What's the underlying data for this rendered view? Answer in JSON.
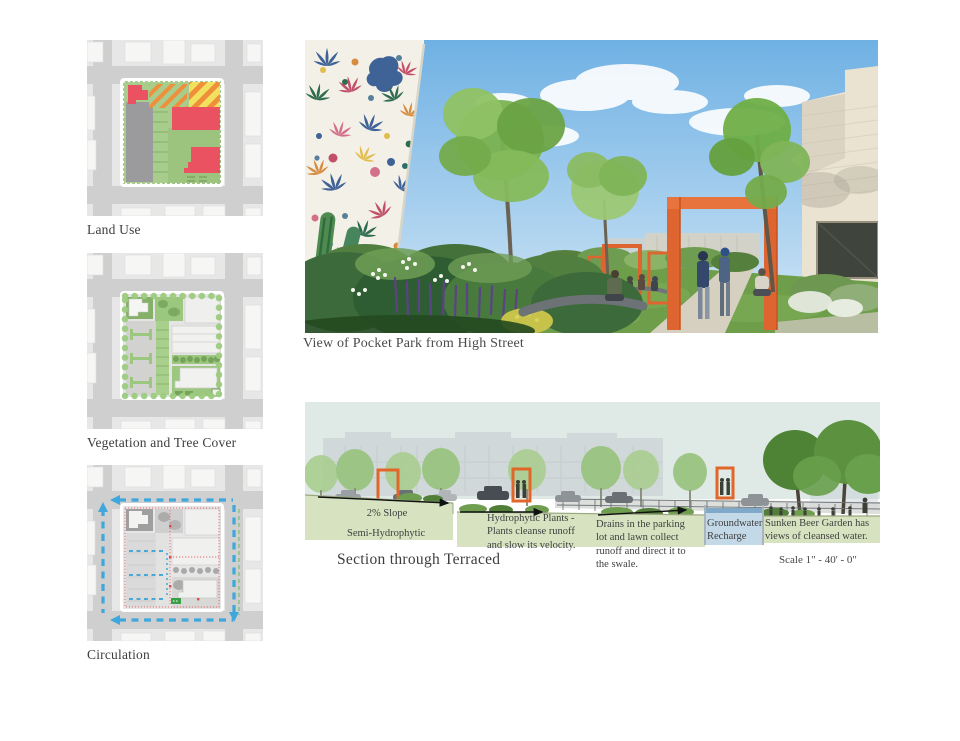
{
  "board": {
    "background": "#ffffff",
    "accent_orange": "#df6530",
    "circulation_blue": "#3fa7dc",
    "landuse_red": "#ea5262",
    "landuse_green": "#a7cc8b",
    "section_ground_green": "#d7e3c0",
    "groundwater_blue": "#c3d9e8"
  },
  "left_column": {
    "maps": [
      {
        "label": "Land Use"
      },
      {
        "label": "Vegetation and Tree Cover"
      },
      {
        "label": "Circulation"
      }
    ]
  },
  "perspective": {
    "caption": "View of Pocket Park from High Street"
  },
  "section": {
    "caption": "Section through Terraced",
    "scale_label": "Scale 1\" - 40' - 0\"",
    "annotations": {
      "slope": "2% Slope",
      "semi_hydrophytic": "Semi-Hydrophytic",
      "hydrophytic_plants": "Hydrophytic Plants - Plants cleanse runoff and slow its velocity.",
      "drains": "Drains in the parking lot and lawn collect runoff and direct it to the swale.",
      "groundwater_recharge": "Groundwater Recharge",
      "sunken_beer_garden": "Sunken Beer Garden has views of cleansed water."
    }
  }
}
